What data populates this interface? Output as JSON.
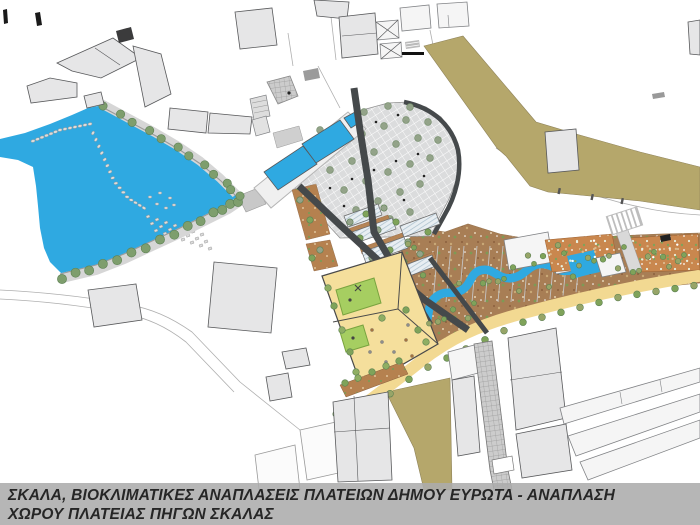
{
  "caption": {
    "line1": "ΣΚΑΛΑ, ΒΙΟΚΛΙΜΑΤΙΚΕΣ ΑΝΑΠΛΑΣΕΙΣ ΠΛΑΤΕΙΩΝ ΔΗΜΟΥ ΕΥΡΩΤΑ - ΑΝΑΠΛΑΣΗ",
    "line2": "ΧΩΡΟΥ ΠΛΑΤΕΙΑΣ ΠΗΓΩΝ ΣΚΑΛΑΣ"
  },
  "colors": {
    "water": "#2fa9e1",
    "khaki": "#b5a76b",
    "building_fill": "#e6e6e7",
    "building_stroke": "#58595b",
    "building_white": "#f5f5f5",
    "road_dark": "#45494b",
    "plaza_tile": "#dbdcdd",
    "earth_brown": "#a87e55",
    "terrace_orange": "#c9874e",
    "terracotta": "#b5814f",
    "sand_yellow": "#f5df9c",
    "play_green": "#a6ce61",
    "play_green_rim": "#79a33f",
    "path_yellow": "#f2d992",
    "tree_green": "#7e9e6d",
    "tree_dark": "#5c8052",
    "tree_olive": "#97a568",
    "caption_bg": "rgba(172,172,172,0.88)",
    "caption_text": "#262626"
  }
}
